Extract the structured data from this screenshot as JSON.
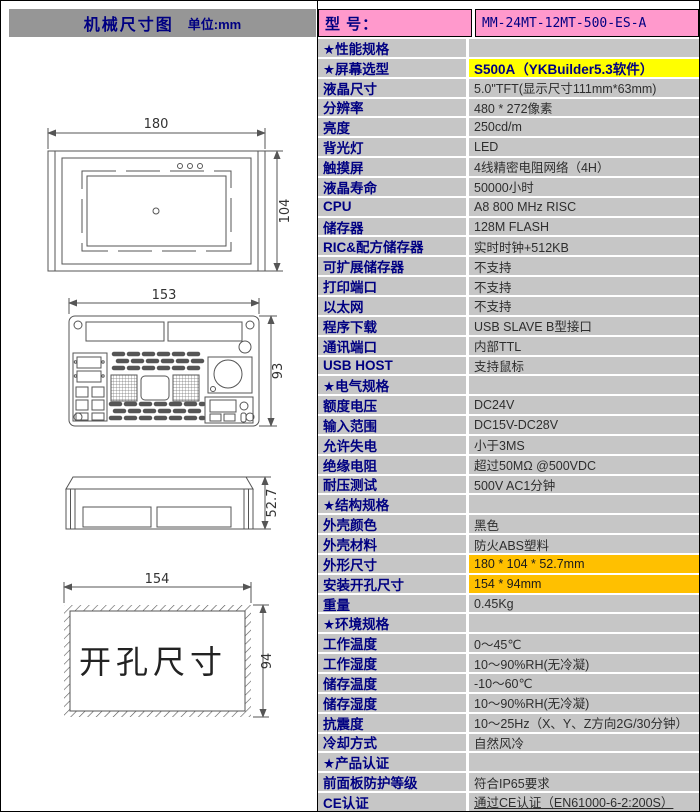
{
  "page": {
    "left_header": {
      "title": "机械尺寸图",
      "unit": "单位:mm"
    },
    "model": {
      "label": "型  号：",
      "value": "MM-24MT-12MT-500-ES-A"
    },
    "drawings": {
      "front": {
        "width_dim": "180",
        "height_dim": "104"
      },
      "back": {
        "width_dim": "153",
        "height_dim": "93"
      },
      "side": {
        "depth_dim": "52.7"
      },
      "cutout": {
        "width_dim": "154",
        "height_dim": "94",
        "label": "开孔尺寸"
      }
    },
    "table": {
      "rows": [
        {
          "label": "★性能规格",
          "value": "",
          "section": true
        },
        {
          "label": "★屏幕选型",
          "value": "S500A（YKBuilder5.3软件）",
          "bg": "yellow"
        },
        {
          "label": "液晶尺寸",
          "value": "5.0\"TFT(显示尺寸111mm*63mm)"
        },
        {
          "label": "分辨率",
          "value": "480 * 272像素"
        },
        {
          "label": "亮度",
          "value": "250cd/m"
        },
        {
          "label": "背光灯",
          "value": "LED"
        },
        {
          "label": "触摸屏",
          "value": "4线精密电阻网络（4H）"
        },
        {
          "label": "液晶寿命",
          "value": "50000小时"
        },
        {
          "label": "CPU",
          "value": "A8 800 MHz RISC"
        },
        {
          "label": "储存器",
          "value": "128M FLASH"
        },
        {
          "label": "RIC&配方储存器",
          "value": "实时时钟+512KB"
        },
        {
          "label": "可扩展储存器",
          "value": "不支持"
        },
        {
          "label": "打印端口",
          "value": "不支持"
        },
        {
          "label": "以太网",
          "value": "不支持"
        },
        {
          "label": "程序下载",
          "value": "USB SLAVE B型接口"
        },
        {
          "label": "通讯端口",
          "value": "内部TTL"
        },
        {
          "label": "USB HOST",
          "value": "支持鼠标"
        },
        {
          "label": "★电气规格",
          "value": "",
          "section": true
        },
        {
          "label": "额度电压",
          "value": "DC24V"
        },
        {
          "label": "输入范围",
          "value": "DC15V-DC28V"
        },
        {
          "label": "允许失电",
          "value": "小于3MS"
        },
        {
          "label": "绝缘电阻",
          "value": "超过50MΩ @500VDC"
        },
        {
          "label": "耐压测试",
          "value": "500V AC1分钟"
        },
        {
          "label": "★结构规格",
          "value": "",
          "section": true
        },
        {
          "label": "外壳颜色",
          "value": "黑色"
        },
        {
          "label": "外壳材料",
          "value": "防火ABS塑料"
        },
        {
          "label": "外形尺寸",
          "value": "180 * 104 * 52.7mm",
          "bg": "gold"
        },
        {
          "label": "安装开孔尺寸",
          "value": "154 * 94mm",
          "bg": "gold"
        },
        {
          "label": "重量",
          "value": "0.45Kg"
        },
        {
          "label": "★环境规格",
          "value": "",
          "section": true
        },
        {
          "label": "工作温度",
          "value": "0～45℃"
        },
        {
          "label": "工作湿度",
          "value": "10～90%RH(无冷凝)"
        },
        {
          "label": "储存温度",
          "value": "-10～60℃"
        },
        {
          "label": "储存湿度",
          "value": "10～90%RH(无冷凝)"
        },
        {
          "label": "抗震度",
          "value": "10～25Hz（X、Y、Z方向2G/30分钟）"
        },
        {
          "label": "冷却方式",
          "value": "自然风冷"
        },
        {
          "label": "★产品认证",
          "value": "",
          "section": true
        },
        {
          "label": "前面板防护等级",
          "value": "符合IP65要求"
        },
        {
          "label": "CE认证",
          "value": "通过CE认证（EN61000-6-2:200S）",
          "underline": true
        }
      ]
    }
  },
  "colors": {
    "header_gray": "#969696",
    "cell_gray": "#c6c6c6",
    "model_pink": "#ff99cc",
    "highlight_yellow": "#ffff00",
    "highlight_gold": "#ffc000",
    "label_navy": "#000082",
    "value_text": "#2e2e2e",
    "drawing_line": "#555555"
  }
}
